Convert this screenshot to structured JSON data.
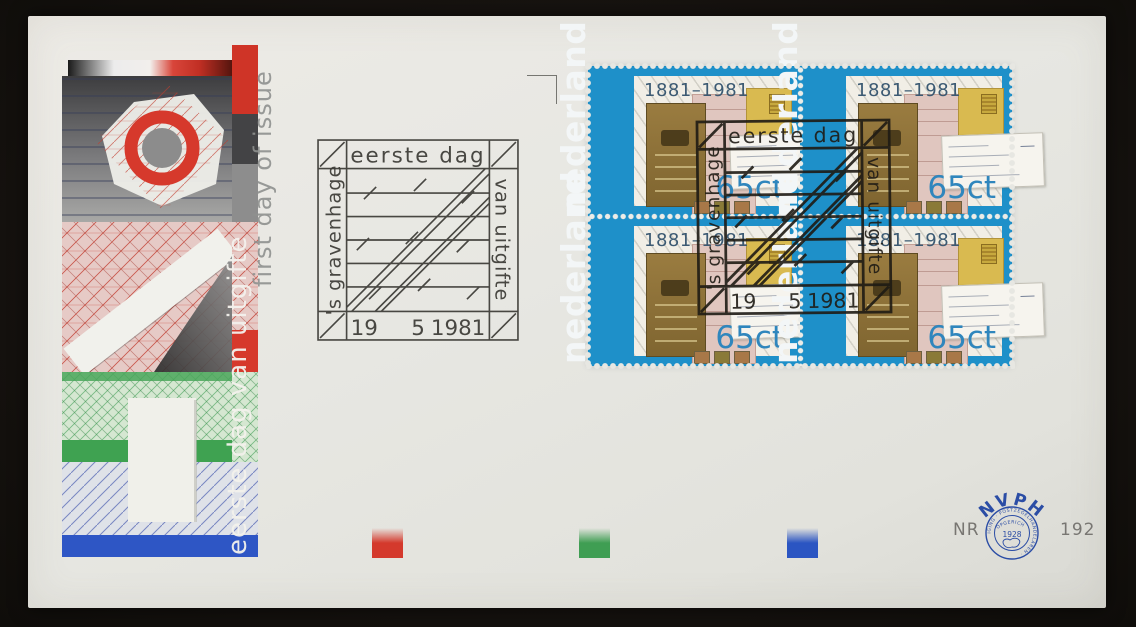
{
  "scene": {
    "background_color": "#171310",
    "envelope_color": "#e7e7e2",
    "description": "First day cover envelope, Netherlands 1981, block of four 65ct stamps '100 jaar Rijkspostspaarbank 1881-1981' with two first-day square cancels"
  },
  "artwork": {
    "vertical_text_dutch": "eerste dag van uitgifte",
    "vertical_text_english": "first day of issue",
    "accent_red": "#d63c2c",
    "accent_green": "#3fa251",
    "accent_blue": "#2e56c5"
  },
  "postmark": {
    "top_text": "eerste dag",
    "left_text": "'s gravenhage",
    "right_text": "van uitgifte",
    "date": {
      "day": "19",
      "month": "5",
      "year": "1981"
    }
  },
  "stamps": {
    "country": "nederland",
    "years": "1881–1981",
    "value": "65ct",
    "count": 4,
    "frame_color": "#1e90c9"
  },
  "color_bars": [
    {
      "name": "red",
      "hex": "#d4392c"
    },
    {
      "name": "green",
      "hex": "#3f9e53"
    },
    {
      "name": "blue",
      "hex": "#2b55c2"
    }
  ],
  "footer": {
    "nr_label": "NR",
    "catalog_number": "192",
    "seal": {
      "org": "NVPH",
      "founded_label": "OPGERICHT",
      "founded": "1928",
      "ring_text": "· VEREENIGING · POSTZEGELHANDELAREN ·",
      "color": "#2b4da5"
    }
  }
}
